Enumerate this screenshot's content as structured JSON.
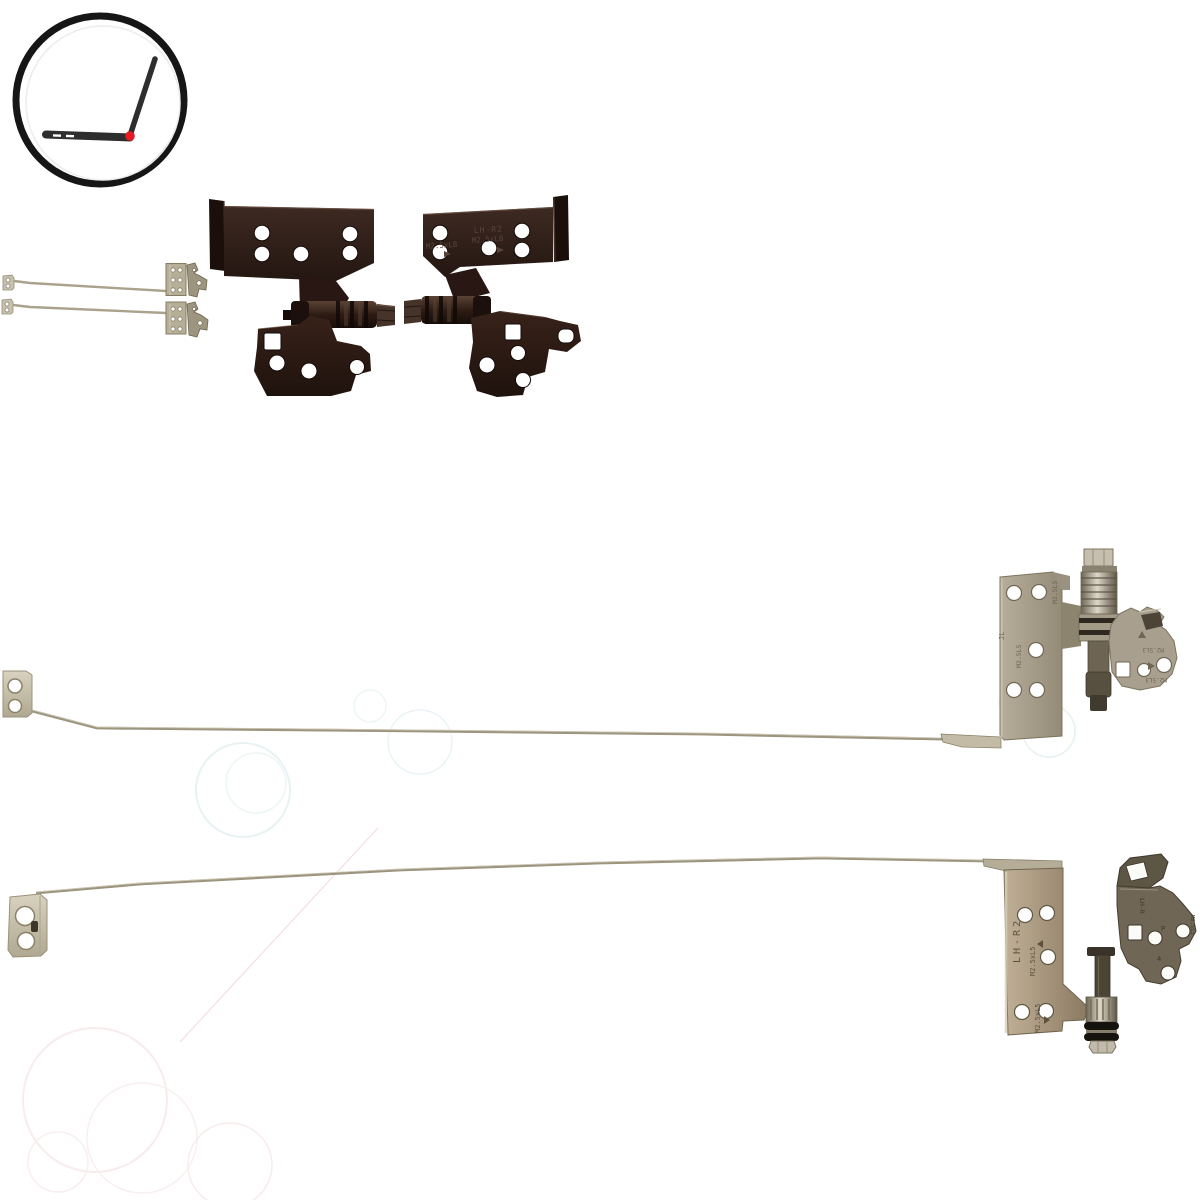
{
  "subject": "laptop-lcd-hinge-set-product-photo",
  "stamps": {
    "hinge_right": {
      "model": "LH-R2",
      "screw_a": "M2.5xL8",
      "screw_b": "M2.5xL8"
    },
    "rail_top_plate": {
      "screw_a": "M2.5L5",
      "screw_b": "M2.5L5",
      "mark": "JL"
    },
    "rail_top_side": {
      "screw_a": "M2.5L3",
      "screw_b": "M2.5L3"
    },
    "rail_bottom_plate": {
      "model": "LH-R2",
      "screw_a": "M2.5xL5",
      "screw_b": "M2.5xL5"
    },
    "rail_bottom_dark": {
      "model": "LH-R",
      "mark_p": "P",
      "screw": "M2.5L3",
      "mark_4": "4"
    }
  },
  "colors": {
    "background": "#ffffff",
    "logo_ring": "#161616",
    "logo_laptop": "#2e2e2e",
    "logo_hinge_dot": "#e51a23",
    "dark_hinge": "#2b1a14",
    "metal_rail": "#9b947f",
    "metal_plate_gray": "#a49b88",
    "metal_plate_bronze": "#9b8a72",
    "stamp_ink_dark": "#5a443a",
    "stamp_ink_metal": "#6f6654",
    "watermark_cool": "#e9f2f3",
    "watermark_warm": "#f7eceb"
  }
}
